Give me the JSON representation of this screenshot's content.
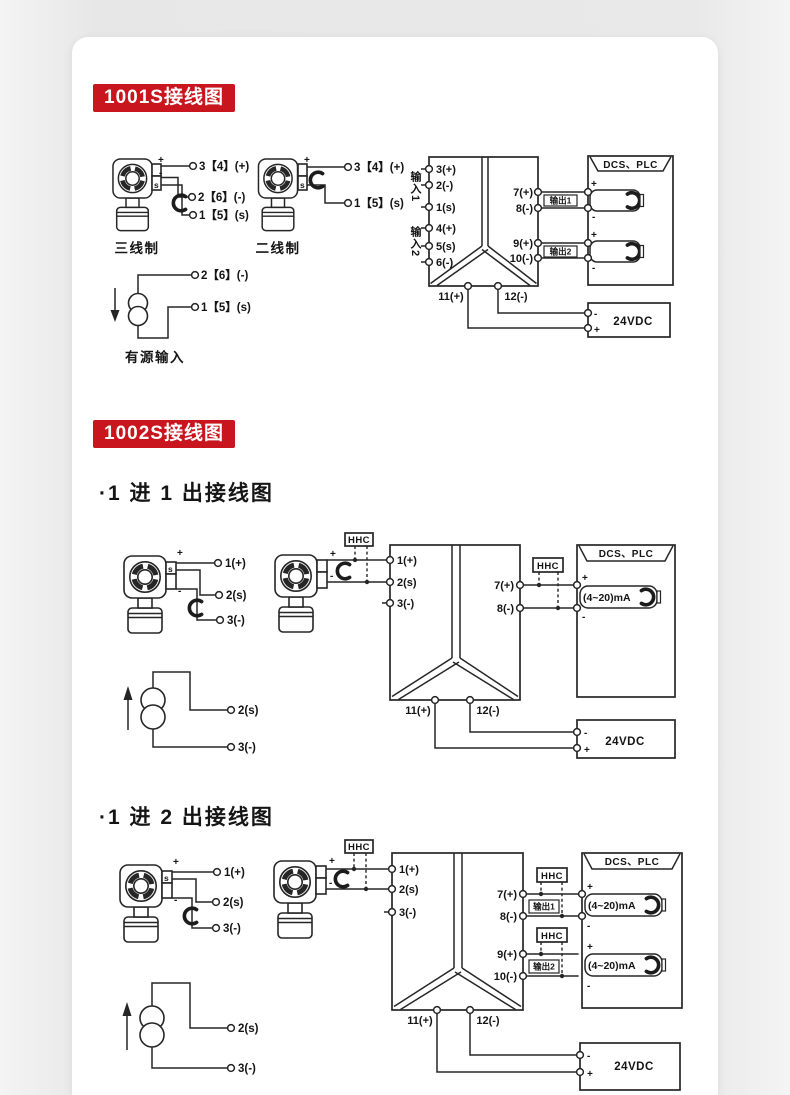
{
  "colors": {
    "badge_bg": "#c9151e",
    "line": "#262626",
    "card_bg": "#ffffff"
  },
  "sections": {
    "s1_badge": "1001S接线图",
    "s2_badge": "1002S接线图",
    "s2_sub1": "·1 进 1 出接线图",
    "s2_sub2": "·1 进 2 出接线图"
  },
  "sym": {
    "plus": "+",
    "minus": "-",
    "s": "s",
    "hhc": "HHC"
  },
  "d1": {
    "three_wire_label": "三线制",
    "two_wire_label": "二线制",
    "active_label": "有源输入",
    "tw3_terms": [
      "3【4】(+)",
      "2【6】(-)",
      "1【5】(s)"
    ],
    "tw2_terms": [
      "3【4】(+)",
      "1【5】(s)"
    ],
    "active_terms": [
      "2【6】(-)",
      "1【5】(s)"
    ],
    "block": {
      "in1": "输入1",
      "in2": "输入2",
      "left": [
        "3(+)",
        "2(-)",
        "1(s)",
        "4(+)",
        "5(s)",
        "6(-)"
      ],
      "right": [
        "7(+)",
        "8(-)",
        "9(+)",
        "10(-)"
      ],
      "out1": "输出1",
      "out2": "输出2",
      "bottom": [
        "11(+)",
        "12(-)"
      ]
    },
    "dcs_title": "DCS、PLC",
    "psu_label": "24VDC"
  },
  "d2": {
    "xmtr_terms": [
      "1(+)",
      "2(s)",
      "3(-)"
    ],
    "block_left": [
      "1(+)",
      "2(s)",
      "3(-)"
    ],
    "block_right": [
      "7(+)",
      "8(-)"
    ],
    "block_bottom": [
      "11(+)",
      "12(-)"
    ],
    "dcs_title": "DCS、PLC",
    "meter": "(4~20)mA",
    "psu_label": "24VDC",
    "src_terms": [
      "2(s)",
      "3(-)"
    ]
  },
  "d3": {
    "xmtr_terms": [
      "1(+)",
      "2(s)",
      "3(-)"
    ],
    "block_left": [
      "1(+)",
      "2(s)",
      "3(-)"
    ],
    "block_right": [
      "7(+)",
      "8(-)",
      "9(+)",
      "10(-)"
    ],
    "out1": "输出1",
    "out2": "输出2",
    "block_bottom": [
      "11(+)",
      "12(-)"
    ],
    "dcs_title": "DCS、PLC",
    "meters": [
      "(4~20)mA",
      "(4~20)mA"
    ],
    "psu_label": "24VDC",
    "src_terms": [
      "2(s)",
      "3(-)"
    ]
  }
}
